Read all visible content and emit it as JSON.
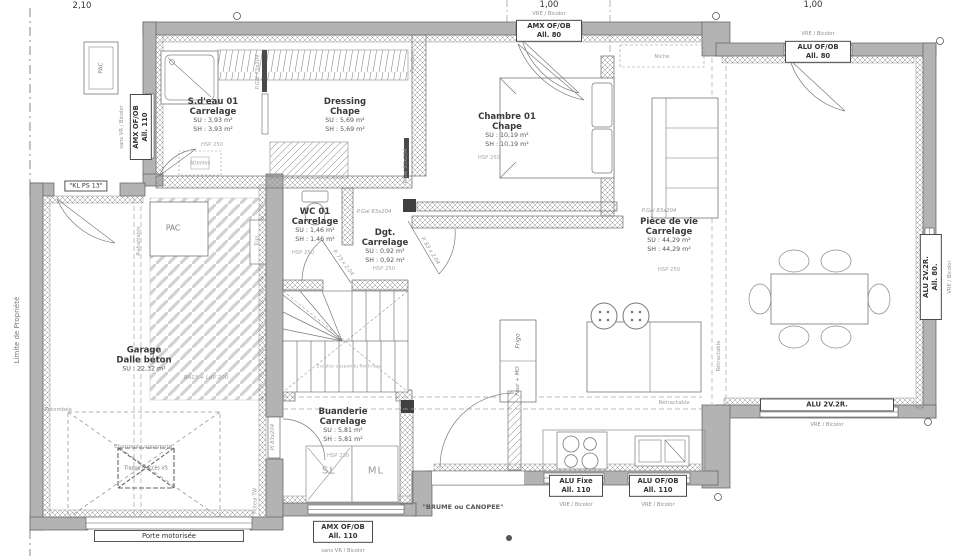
{
  "colors": {
    "wall": "#b3b3b3",
    "line": "#5a5a5a",
    "hatch": "#9a9a9a",
    "dark": "#404040"
  },
  "dimensions": {
    "left": "2,10",
    "mid": "1,00",
    "right": "1,00"
  },
  "site": {
    "property_line": "Limite de Propriété"
  },
  "rooms": {
    "sdeau": {
      "name": "S.d'eau 01",
      "finish": "Carrelage",
      "su": "SU : 3,93 m²",
      "sh": "SH : 3,93 m²",
      "hsp": "HSP 250"
    },
    "dressing": {
      "name": "Dressing",
      "finish": "Chape",
      "su": "SU : 5,69 m²",
      "sh": "SH : 5,69 m²"
    },
    "chambre": {
      "name": "Chambre 01",
      "finish": "Chape",
      "su": "SU : 10,19 m²",
      "sh": "SH : 10,19 m²",
      "hsp": "HSP 250"
    },
    "piece_de_vie": {
      "name": "Pièce de vie",
      "finish": "Carrelage",
      "su": "SU : 44,29 m²",
      "sh": "SH : 44,29 m²",
      "hsp": "HSP 250"
    },
    "wc": {
      "name": "WC 01",
      "finish": "Carrelage",
      "su": "SU : 1,46 m²",
      "sh": "SH : 1,46 m²",
      "hsp": "HSP 250"
    },
    "dgt": {
      "name": "Dgt.",
      "finish": "Carrelage",
      "su": "SU : 0,92 m²",
      "sh": "SH : 0,92 m²",
      "hsp": "HSP 250"
    },
    "buanderie": {
      "name": "Buanderie",
      "finish": "Carrelage",
      "su": "SU : 5,81 m²",
      "sh": "SH : 5,81 m²",
      "hsp": "HSP 230"
    },
    "garage": {
      "name": "Garage",
      "finish": "Dalle béton",
      "su": "SU : 22,32 m²",
      "note": "BA13 + LdV 200"
    }
  },
  "windows": {
    "top_amx": {
      "l1": "AMX OF/OB",
      "l2": "All. 80",
      "note": "VRE / Bicolor"
    },
    "top_alu": {
      "l1": "ALU OF/OB",
      "l2": "All. 80",
      "note": "VRE / Bicolor"
    },
    "left_amx": {
      "l1": "AMX OF/OB",
      "l2": "All. 110",
      "note": "sans VR / Bicolor"
    },
    "right_alu": {
      "l1": "ALU 2V.2R.",
      "l2": "All. 80.",
      "note": "VRE / Bicolor"
    },
    "south_alu": {
      "l1": "ALU 2V.2R.",
      "note": "VRE / Bicolor"
    },
    "kitchen_fixe": {
      "l1": "ALU Fixe",
      "l2": "All. 110",
      "note": "VRE / Bicolor"
    },
    "kitchen_ofob": {
      "l1": "ALU OF/OB",
      "l2": "All. 110",
      "note": "VRE / Bicolor"
    },
    "buanderie_amx": {
      "l1": "AMX OF/OB",
      "l2": "All. 110",
      "note": "sans VR / Bicolor"
    }
  },
  "doors": {
    "kl": "\"KL PS 13\"",
    "porte_motorisee": "Porte motorisée",
    "brume": "\"BRUME ou CANOPEE\"",
    "pgal_73": "P.Gal 73x204",
    "pgal_83_a": "P.Gal 83x204",
    "pgal_83_b": "P.Gal 83x204",
    "pgal_83_c": "P.Gal 83x204",
    "p73": "P. 73 x 2.04",
    "p83": "P. 83 x 2.04",
    "pl83": "Pl 83x204"
  },
  "equipment": {
    "pac_ext": "PAC",
    "pac_garage": "PAC",
    "tripl": "Tripl",
    "moteur": "Moteur TW",
    "frigo": "Frigo",
    "four": "Four + MO",
    "sl": "SL",
    "ml": "ML",
    "attentes": "Attentes"
  },
  "annotations": {
    "niche": "Niche",
    "retombee": "Retombée",
    "rabattable": "Rabattable",
    "retractable_v": "Rétractable",
    "retractable_h": "Rétractable",
    "penderie": "Penderie",
    "charpente": "Charpente apparente",
    "trappe": "Trappe d'accès VS",
    "escalier": "Escalier suspendu Pont-lisse"
  }
}
